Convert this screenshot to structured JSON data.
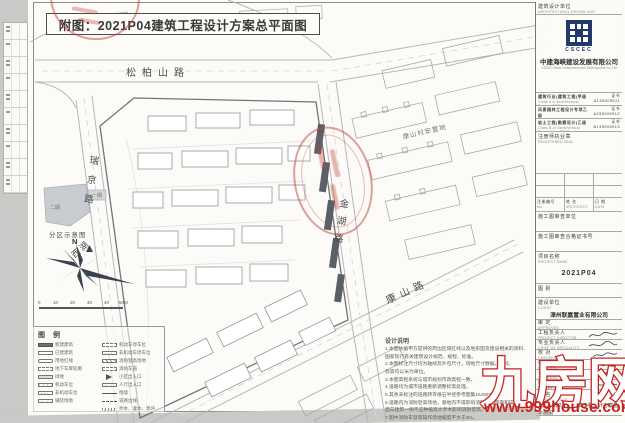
{
  "sheet_title": "附图：2021P04建筑工程设计方案总平面图",
  "roads": {
    "songbaishan": "松柏山路",
    "ruijing": "瑞京路",
    "jinhu": "金湖路",
    "kangshan": "康山路",
    "xihu": "西湖"
  },
  "areas": {
    "resettlement": "康山村安置地"
  },
  "inset": {
    "title": "分区示意图",
    "phase1": "一期",
    "phase2": "二期",
    "north": "N"
  },
  "scalebar": {
    "ticks": [
      "0",
      "10",
      "20",
      "30",
      "40",
      "50M"
    ]
  },
  "legend": {
    "title": "图 例",
    "col1": [
      {
        "label": "新建建筑"
      },
      {
        "label": "已建建筑"
      },
      {
        "label": "用地红线"
      },
      {
        "label": "地下车库轮廓"
      },
      {
        "label": "绿地"
      },
      {
        "label": "机动车位"
      },
      {
        "label": "非机动车位"
      },
      {
        "label": "铺装场地"
      }
    ],
    "col2": [
      {
        "label": "机动车停车位"
      },
      {
        "label": "非机动车停车位"
      },
      {
        "label": "消防登高场地"
      },
      {
        "label": "消防车道"
      },
      {
        "label": "小区出入口"
      },
      {
        "label": "人行出入口"
      },
      {
        "label": "围墙"
      },
      {
        "label": "道路边线"
      },
      {
        "label": "乔木、灌木、草坪"
      }
    ]
  },
  "notes": {
    "title": "设计说明",
    "lines": [
      "1.本图依据甲方提供的周边区域红线以及地形图及建设相关的资料、",
      "国家现行有关建筑设计规范、规程、标准。",
      "2.本图标注尺寸均为轴线及外包尺寸，场地尺寸数据、坐标、",
      "标高均以米为单位。",
      "3.本图高程系统与城市规划市政高程一致。",
      "4.道路均为城市道路重新调整标高处理。",
      "5.其余未标注的道路转弯缘石半径参考图集15J907-4。",
      "6.道路内为消防登高场地，基地内不得影响消防车的停靠和操作，",
      "面向建筑一侧不应种植高大乔木影响消防登高。",
      "7.图中消防车登高操作场地坡度不大于3%。",
      "8.图中尺寸均为建筑外轮廓。"
    ]
  },
  "titleblock": {
    "design_unit": "建筑设计单位",
    "design_unit_en": "ARCHITECTURAL DESIGN UNIT",
    "logo_word": "CSCEC",
    "company_cn": "中建海峡建设发展有限公司",
    "company_en": "CSCEC Strait Construction and Development Co.,Ltd",
    "certs": [
      {
        "cn": "建筑行业(建筑工程)甲级",
        "no": "证书 A135005911",
        "en": "Class A of Architectural Design (PRC)"
      },
      {
        "cn": "风景园林工程设计专项乙级",
        "no": "证书 A235005912",
        "en": "Class B of Landscape Design (PRC)"
      },
      {
        "cn": "岩土工程(勘察设计)乙级",
        "no": "证书 B135005913",
        "en": "Class B of Geotechnical Engineering (PRC)"
      }
    ],
    "seal_label": "注册师执业章",
    "seal_label_en": "REGISTERED SEAL",
    "reg": {
      "no": "注册编号",
      "no_en": "No.",
      "name": "姓 名",
      "name_en": "ARCHITECT",
      "date": "日 期",
      "date_en": "DATE"
    },
    "review_unit": "施工图审查单位",
    "review_cert": "施工图审查合格证书号",
    "project_label": "项目名称",
    "project_label_en": "PROJECT NAME",
    "project_value": "2021P04",
    "type_label": "图 别",
    "client_label": "建设单位",
    "client_label_en": "CLIENT",
    "client_value": "漳州联嘉置业有限公司",
    "rows": [
      {
        "cn": "审 定",
        "en": "APPROVED"
      },
      {
        "cn": "工程负责人",
        "en": "PROJECT DIRECTOR"
      },
      {
        "cn": "专业负责人",
        "en": "CHIEF OF SPECIALITY"
      },
      {
        "cn": "校 对",
        "en": "CHECKED"
      },
      {
        "cn": "审 核",
        "en": "EXAMINED"
      },
      {
        "cn": "设 计",
        "en": "DESIGNED"
      },
      {
        "cn": "制 图",
        "en": "DRAWN"
      }
    ],
    "drawing_title_label": "图 名",
    "drawing_title_label_en": "DRAWING TITLE",
    "drawing_title_value": "附图：2021P04建筑工程设计方案总平面图"
  },
  "watermark": {
    "brand": "九房网",
    "url": "www.999house.com"
  }
}
